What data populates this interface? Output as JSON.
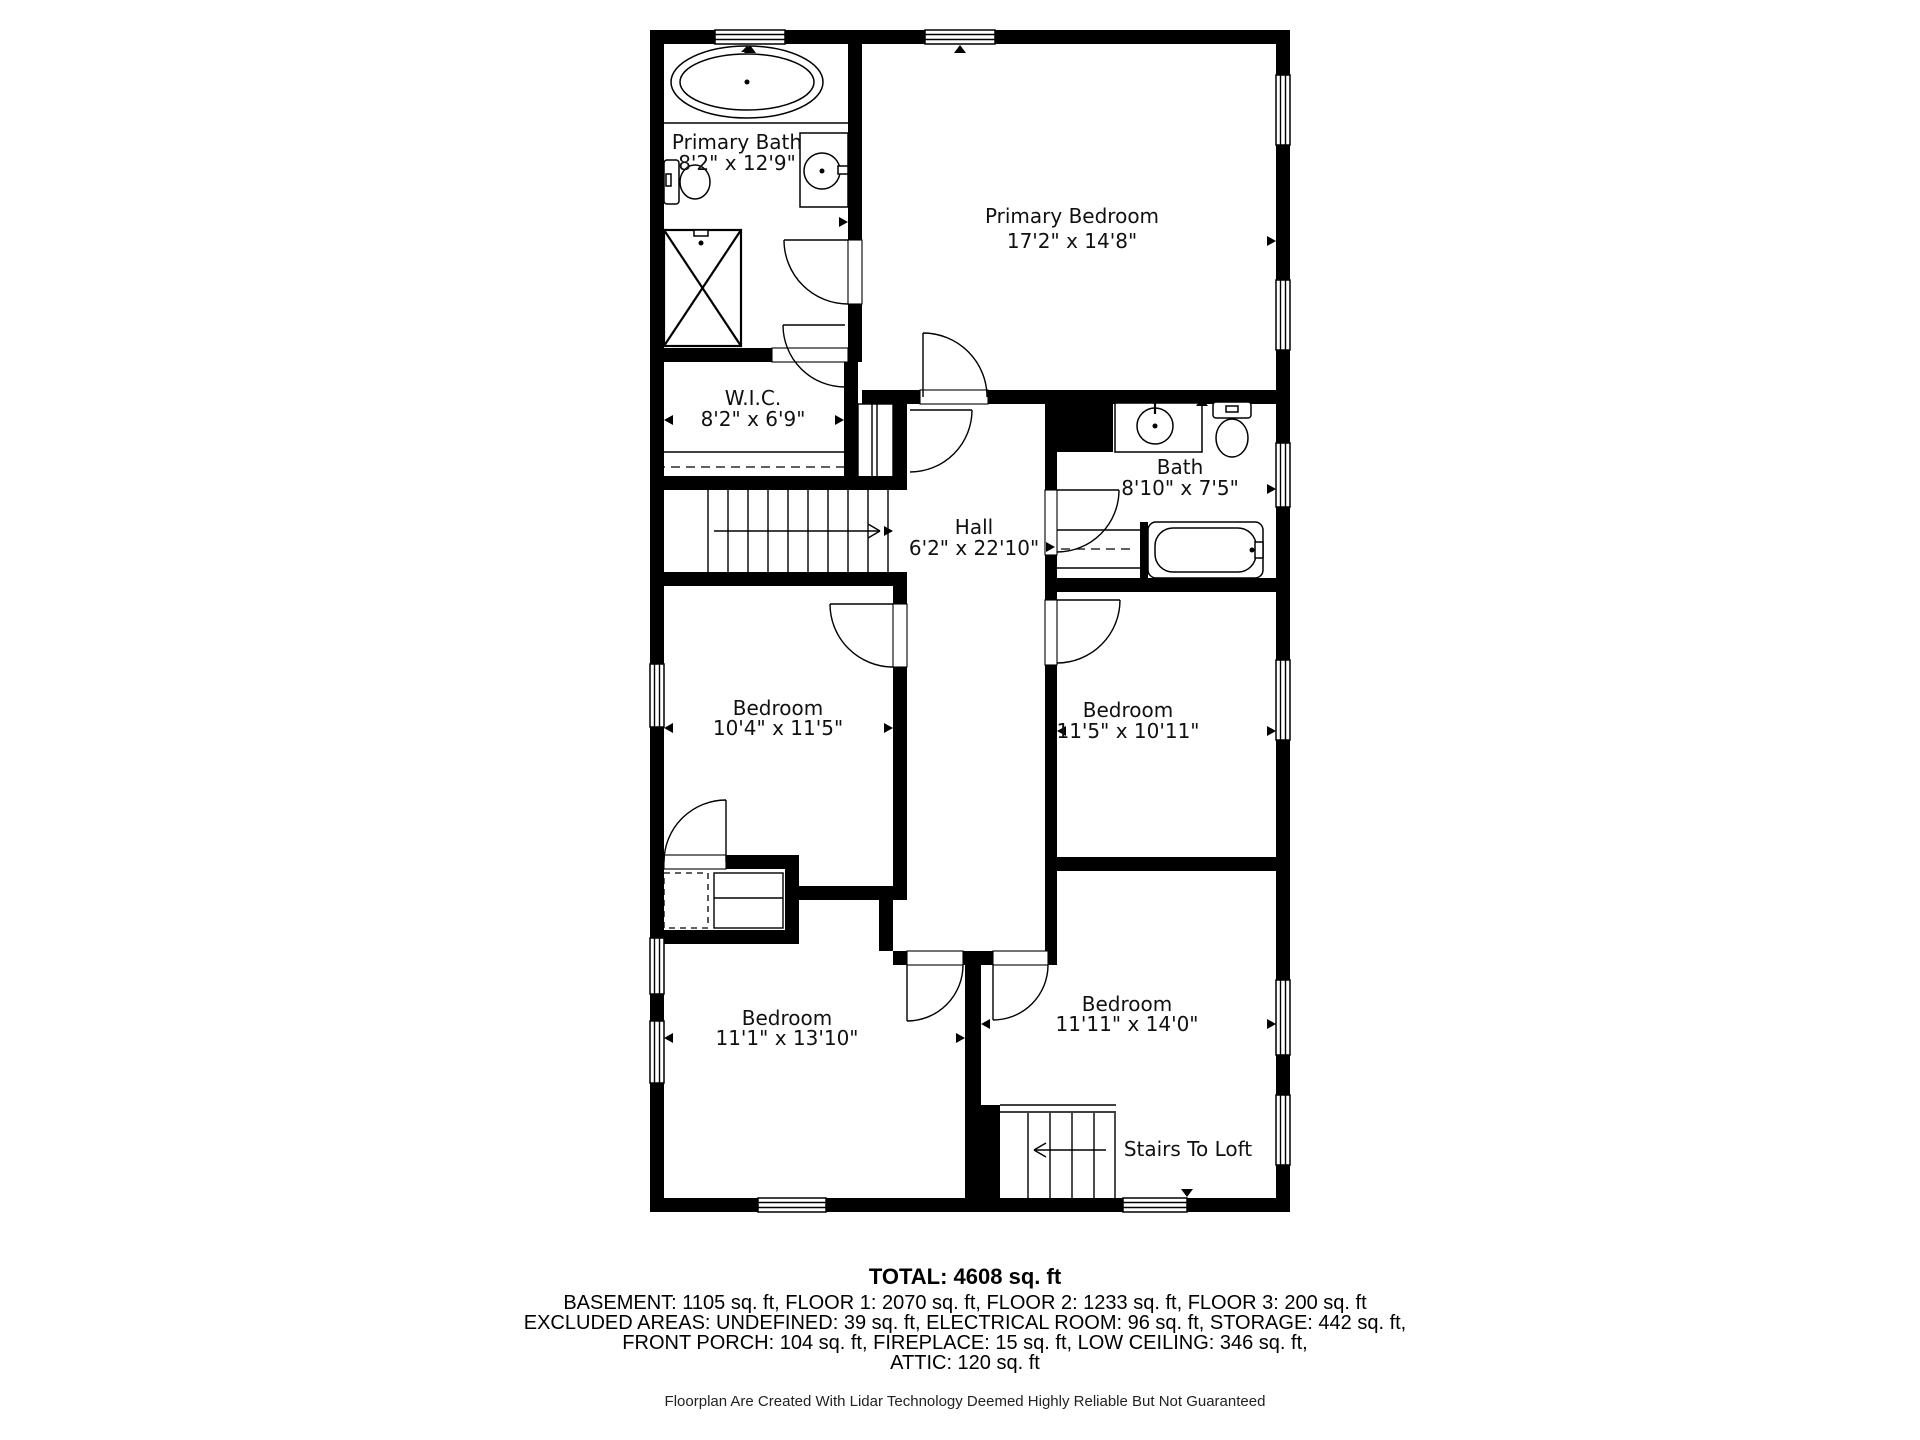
{
  "floorplan": {
    "rooms": [
      {
        "name": "Primary Bath",
        "dims": "8'2\" x 12'9\""
      },
      {
        "name": "Primary Bedroom",
        "dims": "17'2\" x 14'8\""
      },
      {
        "name": "W.I.C.",
        "dims": "8'2\" x 6'9\""
      },
      {
        "name": "Bath",
        "dims": "8'10\" x 7'5\""
      },
      {
        "name": "Hall",
        "dims": "6'2\" x 22'10\""
      },
      {
        "name": "Bedroom",
        "dims": "10'4\" x 11'5\""
      },
      {
        "name": "Bedroom",
        "dims": "11'5\" x 10'11\""
      },
      {
        "name": "Bedroom",
        "dims": "11'1\" x 13'10\""
      },
      {
        "name": "Bedroom",
        "dims": "11'11\" x 14'0\""
      }
    ],
    "labels": {
      "stairs_to_loft": "Stairs To Loft"
    },
    "colors": {
      "wall": "#000000",
      "background": "#ffffff",
      "text": "#111111"
    }
  },
  "summary": {
    "total": "TOTAL: 4608 sq. ft",
    "floors": "BASEMENT: 1105 sq. ft, FLOOR 1: 2070 sq. ft, FLOOR 2: 1233 sq. ft, FLOOR 3: 200 sq. ft",
    "excluded1": "EXCLUDED AREAS: UNDEFINED: 39 sq. ft, ELECTRICAL ROOM: 96 sq. ft, STORAGE: 442 sq. ft,",
    "excluded2": "FRONT PORCH: 104 sq. ft, FIREPLACE: 15 sq. ft, LOW CEILING: 346 sq. ft,",
    "attic": "ATTIC: 120 sq. ft",
    "disclaimer": "Floorplan Are Created With Lidar Technology Deemed Highly Reliable But Not Guaranteed"
  }
}
